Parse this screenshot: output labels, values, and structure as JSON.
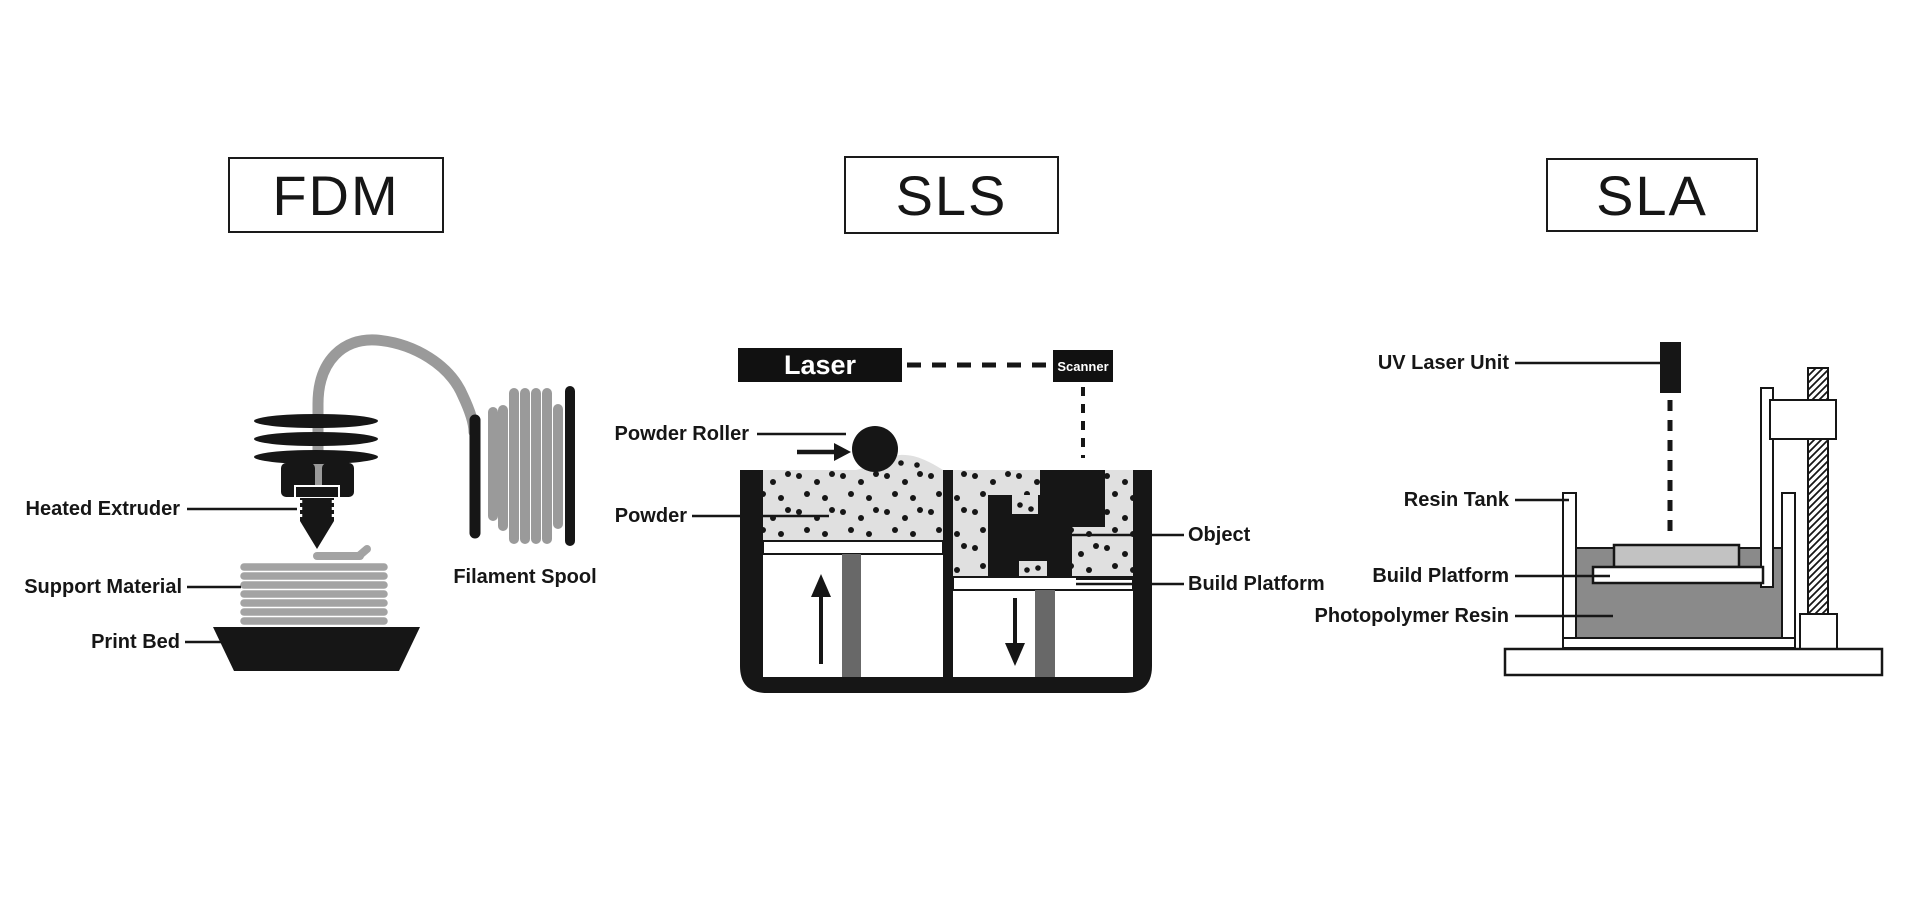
{
  "colors": {
    "ink": "#161616",
    "powder": "#e0e0e0",
    "resin": "#8a8a8a",
    "filament": "#9a9a9a",
    "support": "#a3a3a3",
    "piston": "#686868",
    "printed_part": "#c2c2c2",
    "background": "#ffffff"
  },
  "sections": {
    "fdm": {
      "title": "FDM",
      "labels": {
        "heated_extruder": "Heated Extruder",
        "support_material": "Support Material",
        "print_bed": "Print Bed",
        "filament_spool": "Filament Spool"
      }
    },
    "sls": {
      "title": "SLS",
      "laser": "Laser",
      "scanner": "Scanner",
      "labels": {
        "powder_roller": "Powder Roller",
        "powder": "Powder",
        "object": "Object",
        "build_platform": "Build Platform"
      }
    },
    "sla": {
      "title": "SLA",
      "labels": {
        "uv_laser_unit": "UV Laser Unit",
        "resin_tank": "Resin Tank",
        "build_platform": "Build Platform",
        "photopolymer_resin": "Photopolymer Resin"
      }
    }
  }
}
